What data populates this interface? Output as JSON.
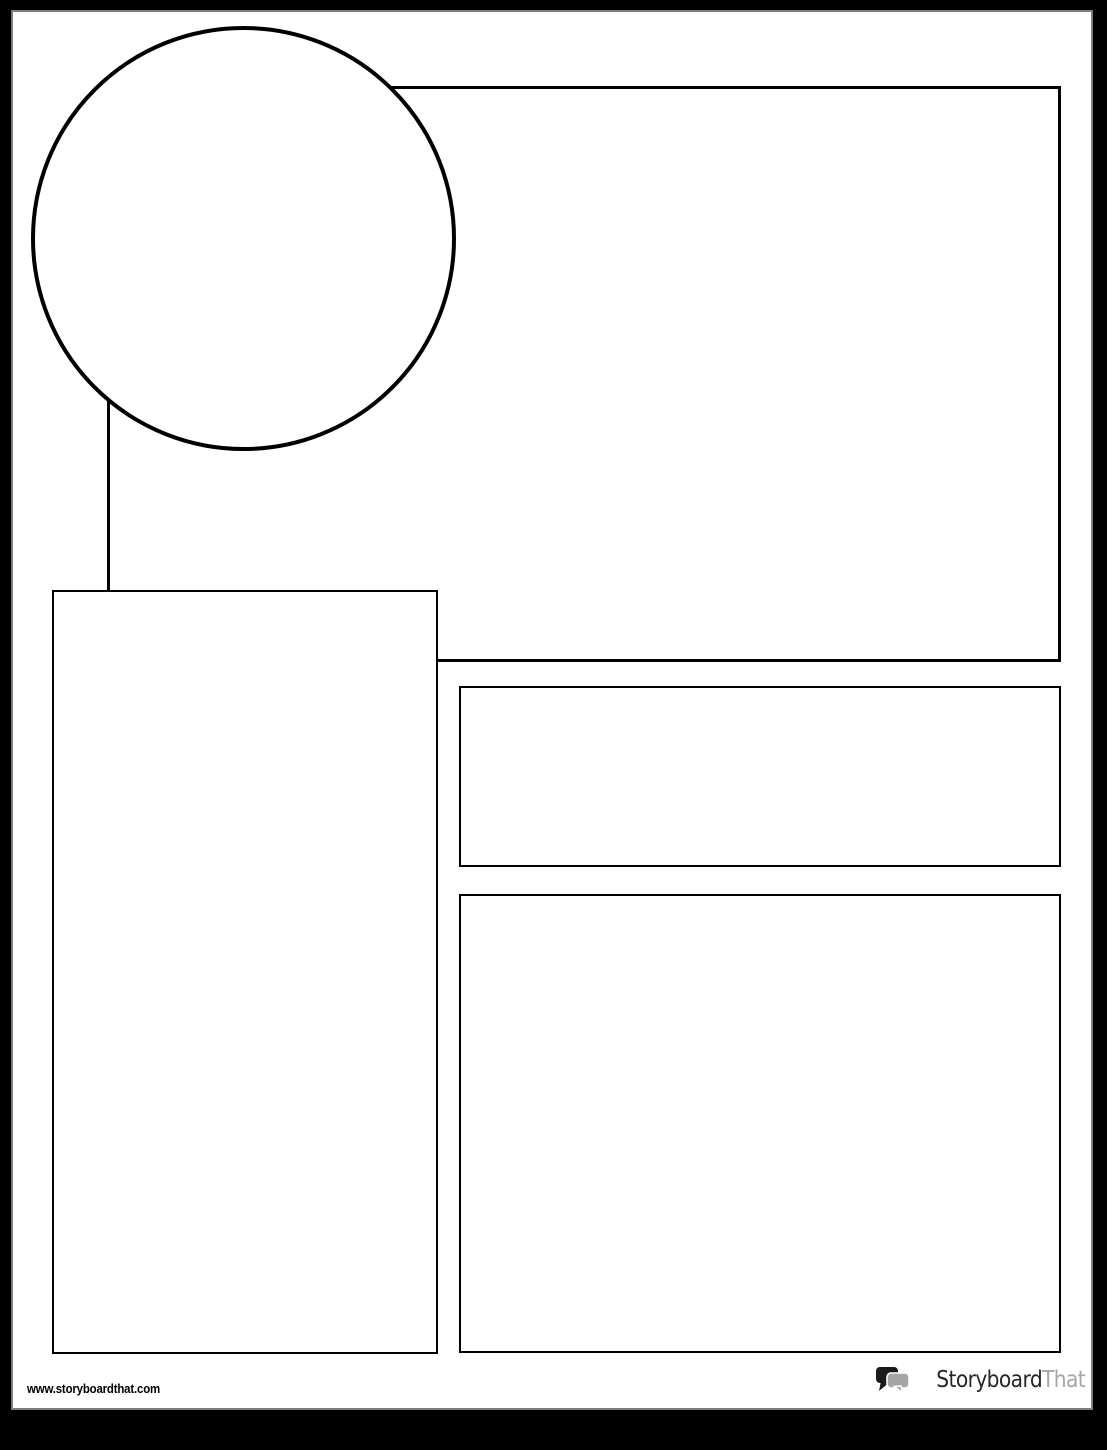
{
  "template": {
    "paper_color": "#ffffff",
    "frame_color": "#000000",
    "stroke_color": "#000000",
    "shapes": [
      {
        "name": "circle-frame",
        "type": "circle"
      },
      {
        "name": "header-box",
        "type": "rectangle"
      },
      {
        "name": "left-column-box",
        "type": "rectangle"
      },
      {
        "name": "subheading-box",
        "type": "rectangle"
      },
      {
        "name": "body-box",
        "type": "rectangle"
      }
    ]
  },
  "footer": {
    "website_url": "www.storyboardthat.com",
    "logo": {
      "icon": "speech-bubbles-icon",
      "text_primary": "Storyboard",
      "text_secondary": "That",
      "colors": {
        "primary_text": "#262626",
        "secondary_text": "#a6a6a6",
        "bubble_dark": "#1b1b1b",
        "bubble_gray": "#a5a5a5"
      }
    }
  }
}
